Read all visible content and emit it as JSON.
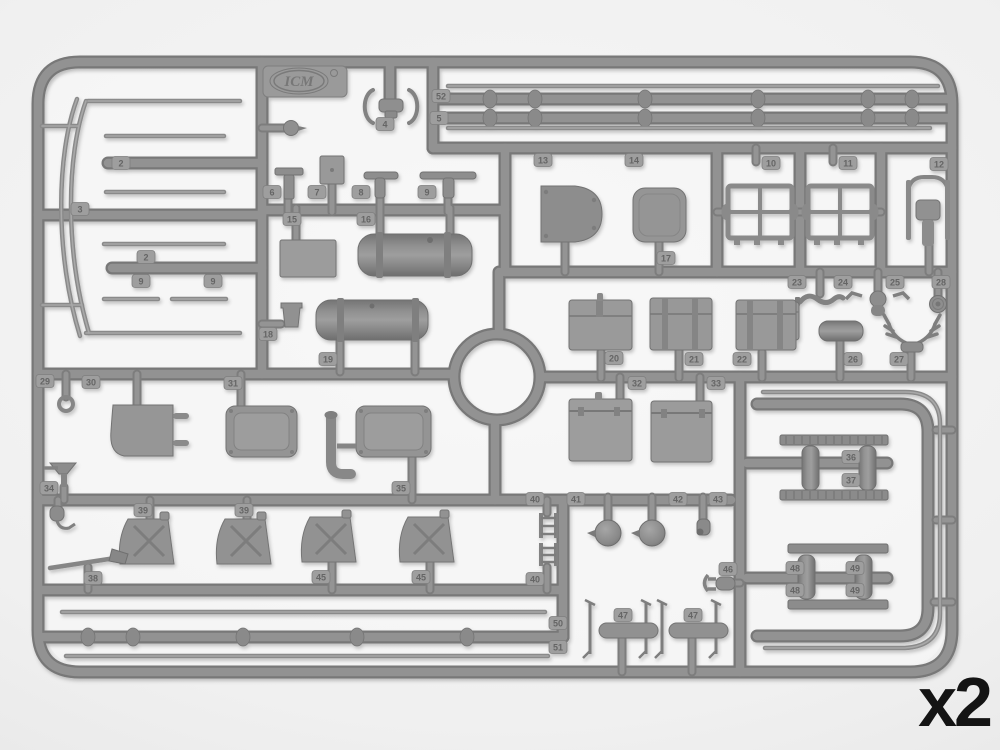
{
  "quantity_label": "x2",
  "brand": {
    "logo_text": "ICM"
  },
  "colors": {
    "background_outer": "#d8d8d8",
    "background_inner": "#f7f7f7",
    "plastic_dark": "#777777",
    "plastic_mid": "#929292",
    "plastic_highlight": "#a9a9a9",
    "part_fill": "#939393",
    "tag_fill": "#9e9e9e",
    "tag_text": "#656565",
    "label_text": "#141414"
  },
  "sprue": {
    "description_tag": "gray-styrene-sprue",
    "part_tags": [
      {
        "n": "2",
        "x": 121,
        "y": 163
      },
      {
        "n": "3",
        "x": 80,
        "y": 209
      },
      {
        "n": "2",
        "x": 146,
        "y": 257
      },
      {
        "n": "9",
        "x": 141,
        "y": 281
      },
      {
        "n": "9",
        "x": 213,
        "y": 281
      },
      {
        "n": "4",
        "x": 385,
        "y": 124
      },
      {
        "n": "6",
        "x": 272,
        "y": 192
      },
      {
        "n": "7",
        "x": 317,
        "y": 192
      },
      {
        "n": "8",
        "x": 361,
        "y": 192
      },
      {
        "n": "9",
        "x": 427,
        "y": 192
      },
      {
        "n": "15",
        "x": 292,
        "y": 219
      },
      {
        "n": "16",
        "x": 366,
        "y": 219
      },
      {
        "n": "18",
        "x": 268,
        "y": 334
      },
      {
        "n": "19",
        "x": 328,
        "y": 359
      },
      {
        "n": "52",
        "x": 441,
        "y": 96
      },
      {
        "n": "5",
        "x": 439,
        "y": 118
      },
      {
        "n": "13",
        "x": 543,
        "y": 160
      },
      {
        "n": "14",
        "x": 634,
        "y": 160
      },
      {
        "n": "17",
        "x": 666,
        "y": 258
      },
      {
        "n": "10",
        "x": 771,
        "y": 163
      },
      {
        "n": "11",
        "x": 848,
        "y": 163
      },
      {
        "n": "12",
        "x": 939,
        "y": 164
      },
      {
        "n": "23",
        "x": 797,
        "y": 282
      },
      {
        "n": "24",
        "x": 843,
        "y": 282
      },
      {
        "n": "25",
        "x": 895,
        "y": 282
      },
      {
        "n": "28",
        "x": 941,
        "y": 282
      },
      {
        "n": "26",
        "x": 853,
        "y": 359
      },
      {
        "n": "27",
        "x": 899,
        "y": 359
      },
      {
        "n": "20",
        "x": 614,
        "y": 358
      },
      {
        "n": "21",
        "x": 694,
        "y": 359
      },
      {
        "n": "22",
        "x": 742,
        "y": 359
      },
      {
        "n": "32",
        "x": 637,
        "y": 383
      },
      {
        "n": "33",
        "x": 716,
        "y": 383
      },
      {
        "n": "29",
        "x": 45,
        "y": 381
      },
      {
        "n": "30",
        "x": 91,
        "y": 382
      },
      {
        "n": "31",
        "x": 233,
        "y": 383
      },
      {
        "n": "34",
        "x": 49,
        "y": 488
      },
      {
        "n": "35",
        "x": 401,
        "y": 488
      },
      {
        "n": "38",
        "x": 93,
        "y": 578
      },
      {
        "n": "39",
        "x": 143,
        "y": 510
      },
      {
        "n": "39",
        "x": 244,
        "y": 510
      },
      {
        "n": "45",
        "x": 321,
        "y": 577
      },
      {
        "n": "45",
        "x": 421,
        "y": 577
      },
      {
        "n": "40",
        "x": 535,
        "y": 499
      },
      {
        "n": "41",
        "x": 576,
        "y": 499
      },
      {
        "n": "42",
        "x": 678,
        "y": 499
      },
      {
        "n": "43",
        "x": 718,
        "y": 499
      },
      {
        "n": "40",
        "x": 535,
        "y": 579
      },
      {
        "n": "46",
        "x": 728,
        "y": 569
      },
      {
        "n": "47",
        "x": 623,
        "y": 615
      },
      {
        "n": "47",
        "x": 693,
        "y": 615
      },
      {
        "n": "50",
        "x": 558,
        "y": 623
      },
      {
        "n": "51",
        "x": 558,
        "y": 647
      },
      {
        "n": "36",
        "x": 851,
        "y": 457
      },
      {
        "n": "37",
        "x": 851,
        "y": 480
      },
      {
        "n": "48",
        "x": 795,
        "y": 568
      },
      {
        "n": "49",
        "x": 855,
        "y": 568
      },
      {
        "n": "48",
        "x": 795,
        "y": 590
      },
      {
        "n": "49",
        "x": 855,
        "y": 590
      }
    ]
  }
}
